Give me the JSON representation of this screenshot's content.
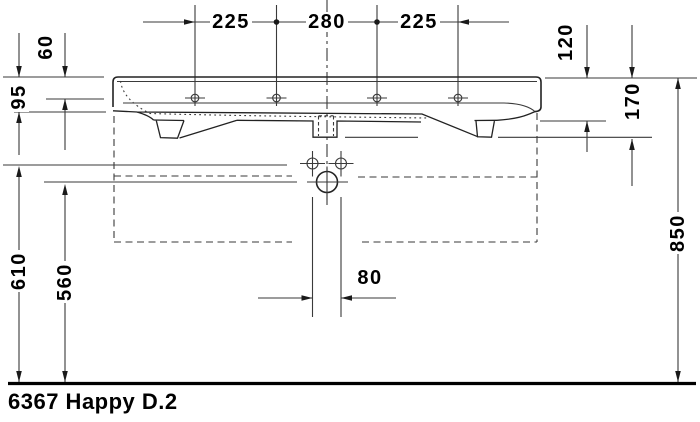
{
  "drawing": {
    "product_label": "6367 Happy D.2",
    "dimensions": {
      "tap_hole_spacing_left": "225",
      "tap_hole_spacing_center": "280",
      "tap_hole_spacing_right": "225",
      "rim_to_tap_hole": "60",
      "front_apron_height": "95",
      "rim_to_underside": "120",
      "rim_to_lowest_point": "170",
      "floor_to_rim": "850",
      "floor_to_fixing_holes": "610",
      "floor_to_drain": "560",
      "drain_hole_offset": "80"
    }
  }
}
